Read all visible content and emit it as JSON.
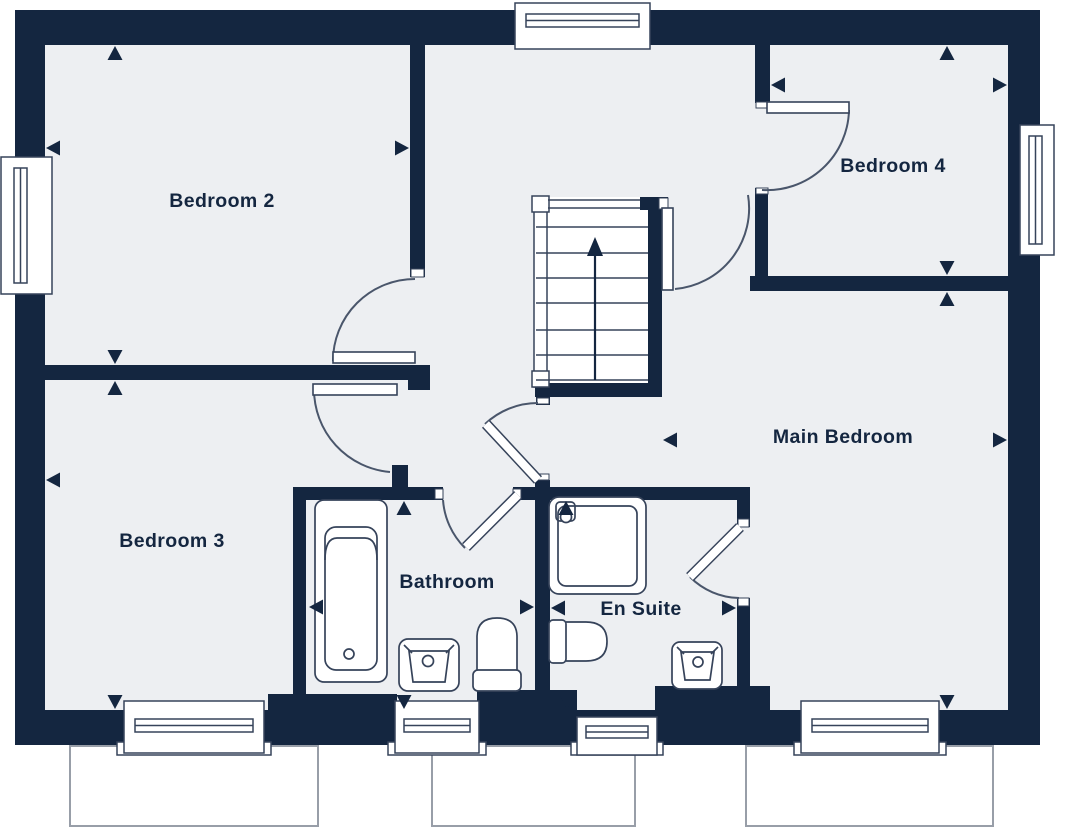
{
  "plan": {
    "rooms": {
      "bedroom_2": {
        "label": "Bedroom 2"
      },
      "bedroom_3": {
        "label": "Bedroom 3"
      },
      "bedroom_4": {
        "label": "Bedroom 4"
      },
      "main_bedroom": {
        "label": "Main Bedroom"
      },
      "bathroom": {
        "label": "Bathroom"
      },
      "en_suite": {
        "label": "En Suite"
      }
    },
    "colors": {
      "wall": "#142640",
      "room_fill": "#edeff2",
      "detail_line": "#36435a",
      "arc_line": "#4a566b",
      "ground_outline": "#989ea8",
      "background": "#ffffff",
      "label_text": "#142640"
    },
    "icons": {
      "stairs_direction": "up-arrow",
      "dimension_marker": "triangle-arrowhead"
    }
  }
}
